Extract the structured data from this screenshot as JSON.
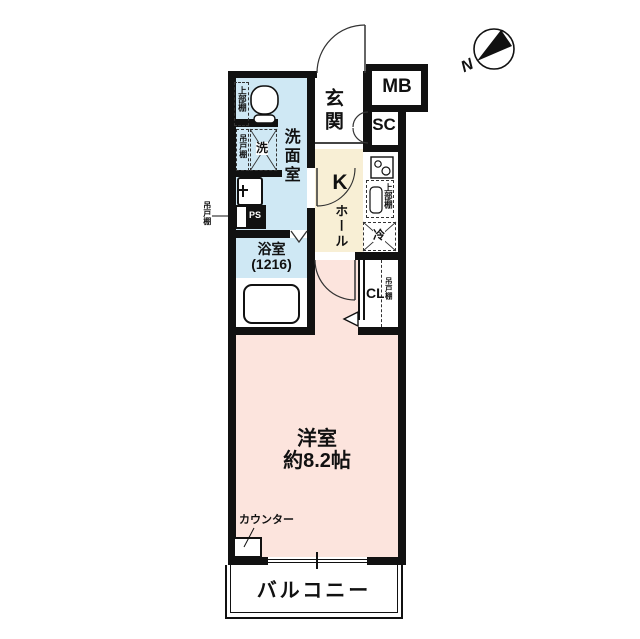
{
  "title": "apartment-floor-plan",
  "colors": {
    "wall": "#111111",
    "wet_area": "#cfe8f4",
    "kitchen_hall": "#f8efd5",
    "room": "#fce4dd",
    "background": "#ffffff"
  },
  "compass": {
    "label": "N"
  },
  "rooms": {
    "entrance": {
      "label": "玄関"
    },
    "meter_box": {
      "label": "MB"
    },
    "shoe_closet": {
      "label": "SC"
    },
    "washroom": {
      "label": "洗面室"
    },
    "bathroom": {
      "label": "浴室",
      "size": "(1216)"
    },
    "kitchen": {
      "label": "K"
    },
    "hall": {
      "label": "ホール"
    },
    "closet": {
      "label": "CL"
    },
    "main_room": {
      "label": "洋室",
      "size": "約8.2帖"
    },
    "balcony": {
      "label": "バルコニー"
    }
  },
  "fixtures": {
    "toilet_upper_shelf": "上部棚",
    "washer": "洗",
    "washer_hanging_shelf": "吊戸棚",
    "wall_hanging_shelf": "吊戸棚",
    "pipe_space": "PS",
    "kitchen_upper_shelf": "上部棚",
    "refrigerator": "冷",
    "closet_hanging_shelf": "吊戸棚",
    "counter": "カウンター"
  }
}
